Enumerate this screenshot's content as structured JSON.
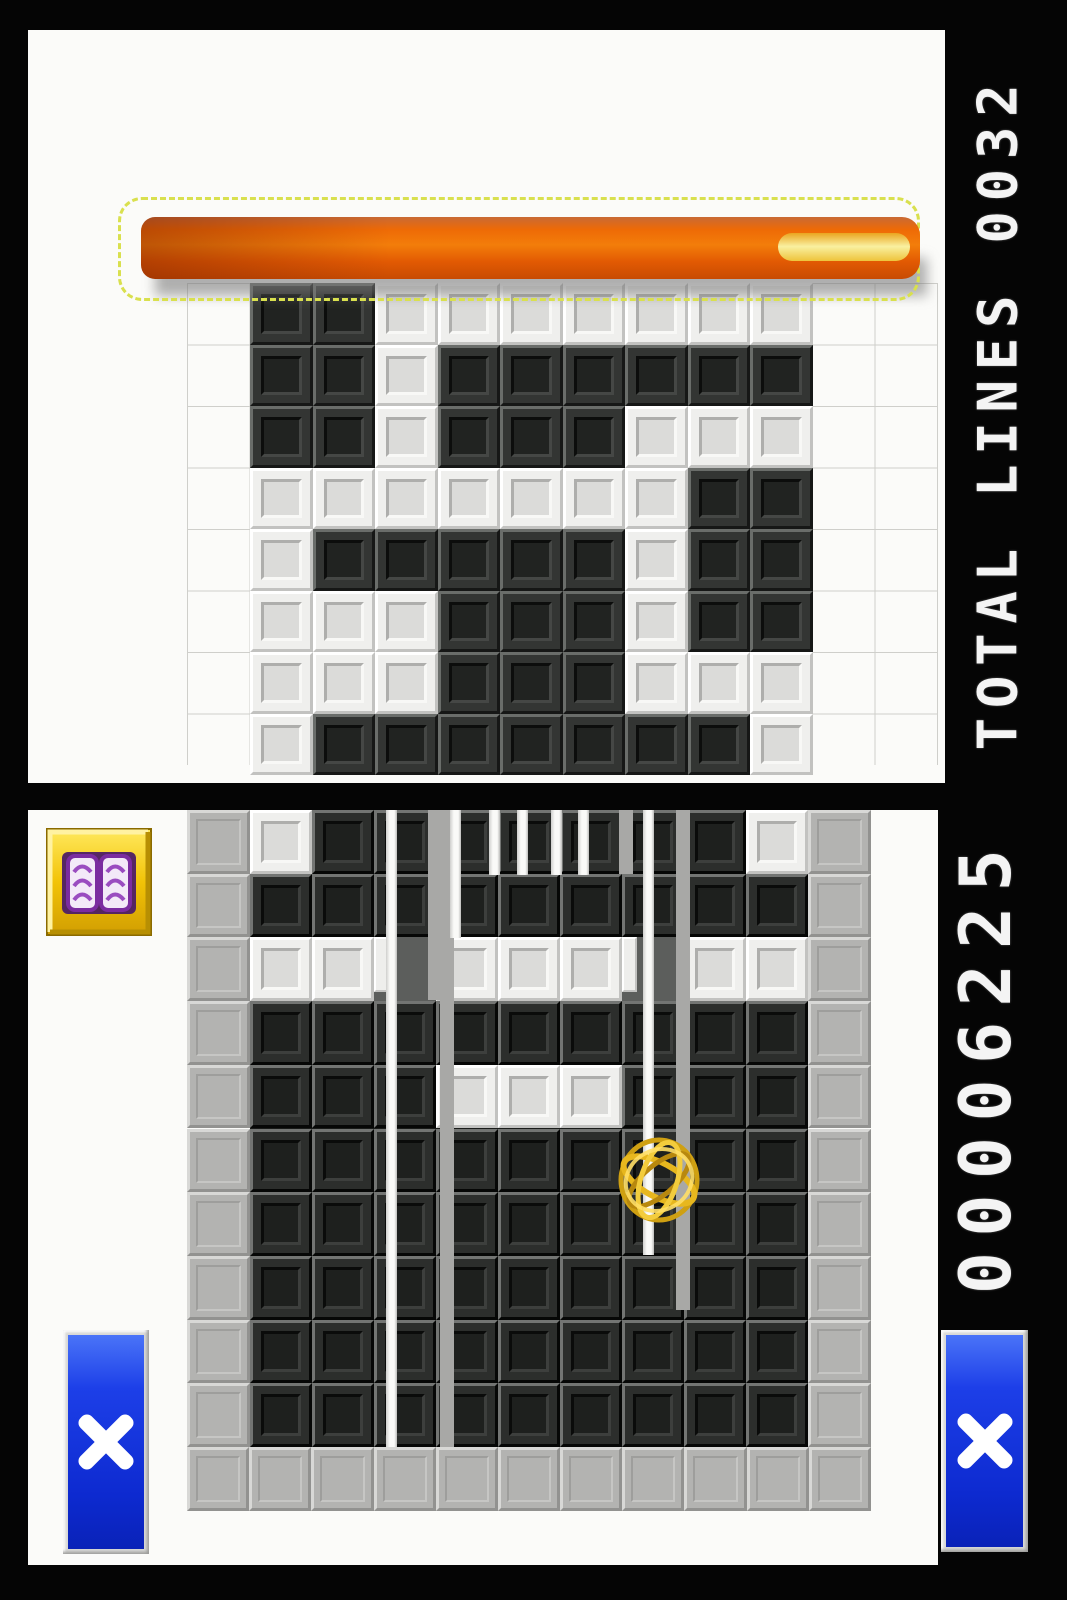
{
  "top_screen": {
    "score_text": "TOTAL LINES 0032",
    "timer_bar": {
      "fill_color": "#ee6a06",
      "remaining_pill_color": "#f9f0a0",
      "marquee_color": "#d9e04e"
    },
    "grid": {
      "cols": 9,
      "rows": 8,
      "legend": {
        "B": "black tile",
        "W": "white tile"
      },
      "map": [
        "BBWWWWWWW",
        "BBWBBBBBB",
        "BBWBBBWWW",
        "WWWWWWWBB",
        "WBBBBBWBB",
        "WWWBBBWBB",
        "WWWBBBWWW",
        "WBBBBBBBW"
      ]
    }
  },
  "bottom_screen": {
    "score_text": "00006225",
    "grid": {
      "cols": 9,
      "rows": 10,
      "legend": {
        "B": "black tile",
        "W": "white tile",
        "F": "tile mid-flip"
      },
      "map": [
        "WBBBBBBBW",
        "BBBBBBBBB",
        "WWFWWWFWW",
        "BBBBBBBBB",
        "BBBWWWBBB",
        "BBBBBBBBB",
        "BBBBBBBBB",
        "BBBBBBBBB",
        "BBBBBBBBB",
        "BBBBBBBBB"
      ]
    },
    "stripes": {
      "white": [
        [
          386,
          810,
          637
        ],
        [
          643,
          810,
          445
        ],
        [
          450,
          810,
          128
        ],
        [
          489,
          810,
          65
        ],
        [
          517,
          810,
          65
        ],
        [
          551,
          810,
          65
        ],
        [
          578,
          810,
          65
        ]
      ],
      "gray": [
        [
          440,
          810,
          637
        ],
        [
          676,
          810,
          500
        ],
        [
          428,
          810,
          190
        ],
        [
          619,
          810,
          64
        ]
      ]
    },
    "cursor": {
      "icon": "gold-wireframe-ball",
      "x": 659,
      "y": 1180
    },
    "book_button": {
      "icon": "open-book-icon"
    },
    "close_button_left": {
      "icon": "x-cross-icon"
    },
    "close_button_right": {
      "icon": "x-cross-icon"
    }
  },
  "colors": {
    "score-text": "#f4f4f4",
    "marquee": "#d9e04e",
    "bar-orange": "#ee6a06",
    "pill-yellow": "#f9f0a0",
    "button-blue": "#1d3fe8",
    "book-gold": "#f2c307",
    "book-purple": "#7b2ca0",
    "black-tile": "#2e302e",
    "white-tile": "#efefed",
    "border-gray-tile": "#b3b3b1",
    "cursor-gold": "#e7b71e",
    "screen-white": "#fbfbf9",
    "bezel-black": "#050505"
  }
}
